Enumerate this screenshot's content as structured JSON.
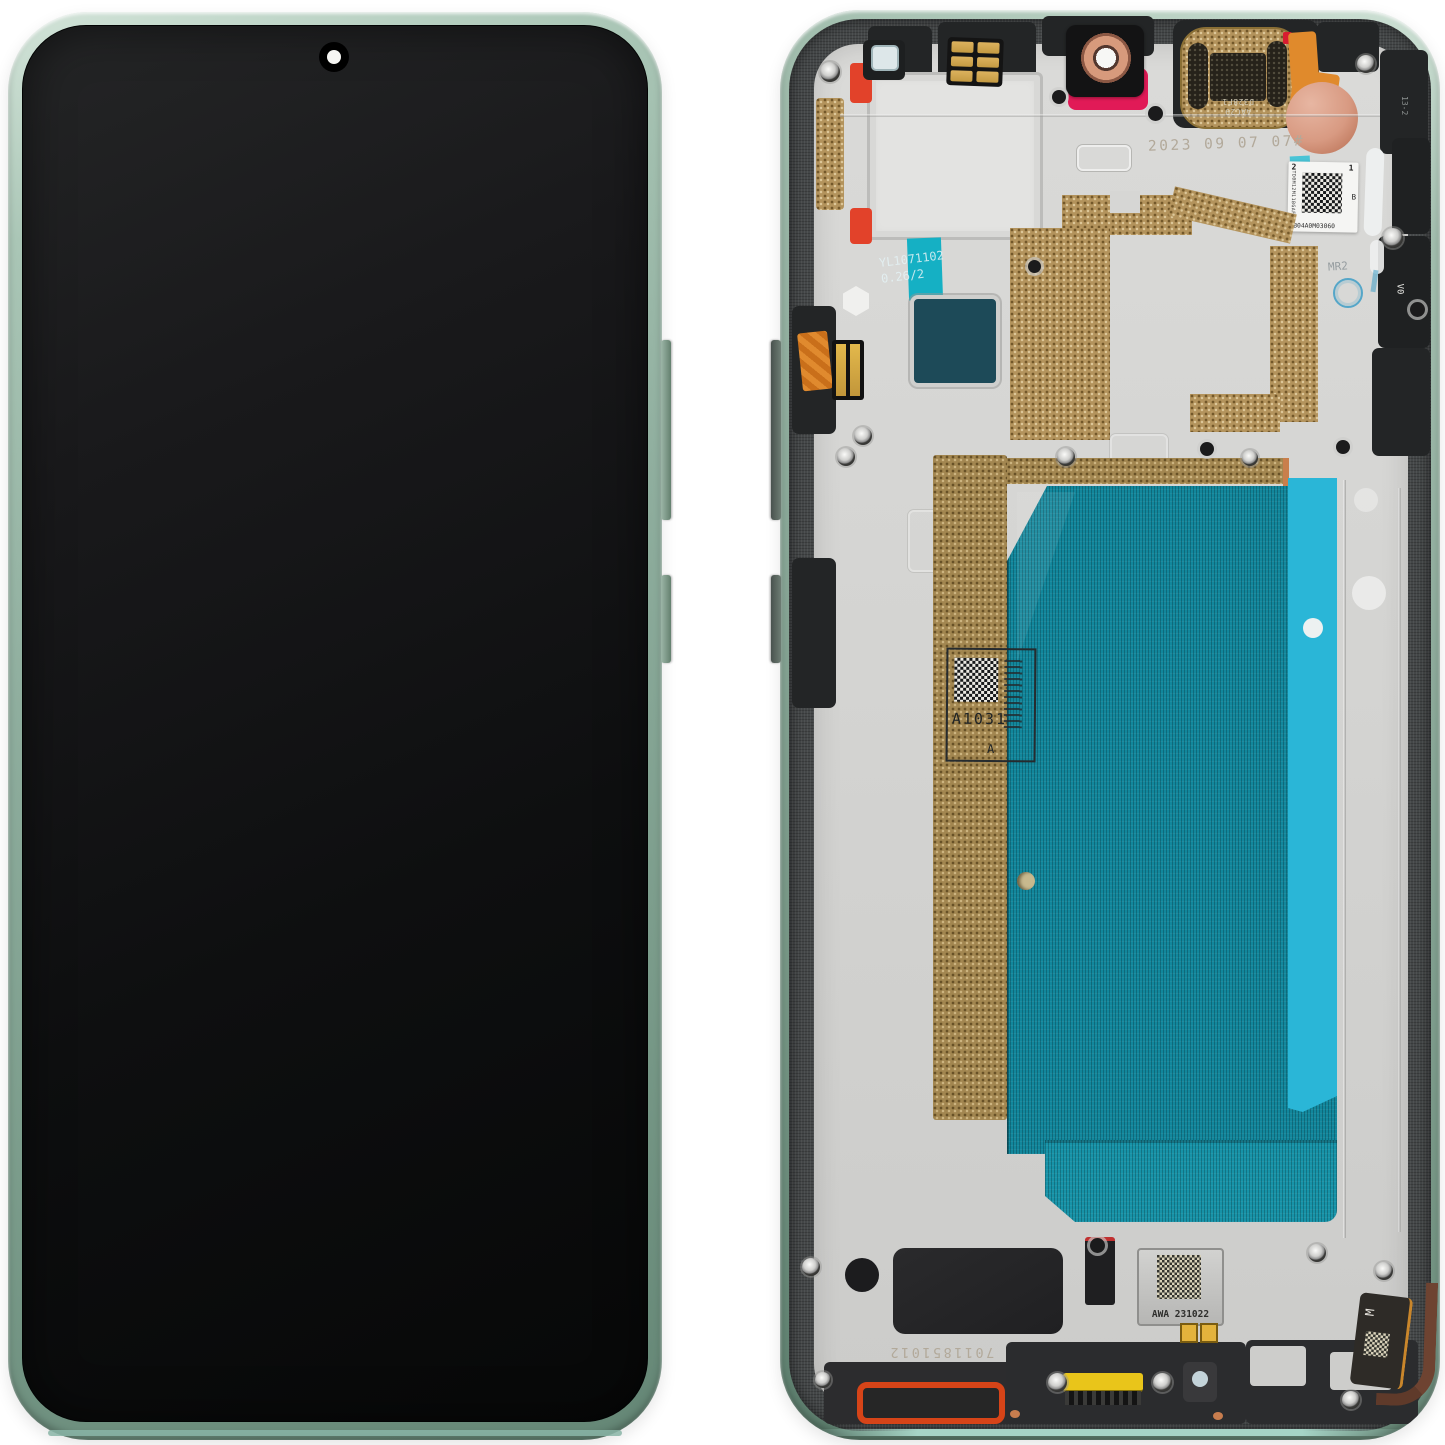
{
  "front": {
    "frame_color": "#8fae9e",
    "screen_color": "#0e0f10"
  },
  "back": {
    "frame_color": "#8aa898",
    "plate_color": "#d4d4d2",
    "adhesive_teal": "#12879c",
    "adhesive_cyan": "#2ab6d7",
    "emi_gold": "#b3935c",
    "camera_gasket_magenta": "#e11a57",
    "bottom_gasket_red": "#d64418",
    "connector_yellow": "#e9c51a",
    "tape_cyan": "#15b0c4",
    "markings": {
      "date_code": "2023 09 07 07#",
      "top_label": {
        "corner_left": "2",
        "corner_right": "1",
        "grade": "B",
        "vertical_code": "TD0M12M11BGAF",
        "serial": "3B04A0M03060"
      },
      "earpiece_line1": "AAC29",
      "earpiece_line2": "D328F1",
      "tape_line1": "YL1071102",
      "tape_line2": "0.26/2",
      "mid_label_code": "A1031",
      "mid_label_rev": "A",
      "module_code": "AWA 231022",
      "bottom_stamp": "7011851012",
      "mold_mr2": "MR2",
      "mold_v0": "V0",
      "flex_m": "M",
      "rim_code": "13-2"
    }
  }
}
